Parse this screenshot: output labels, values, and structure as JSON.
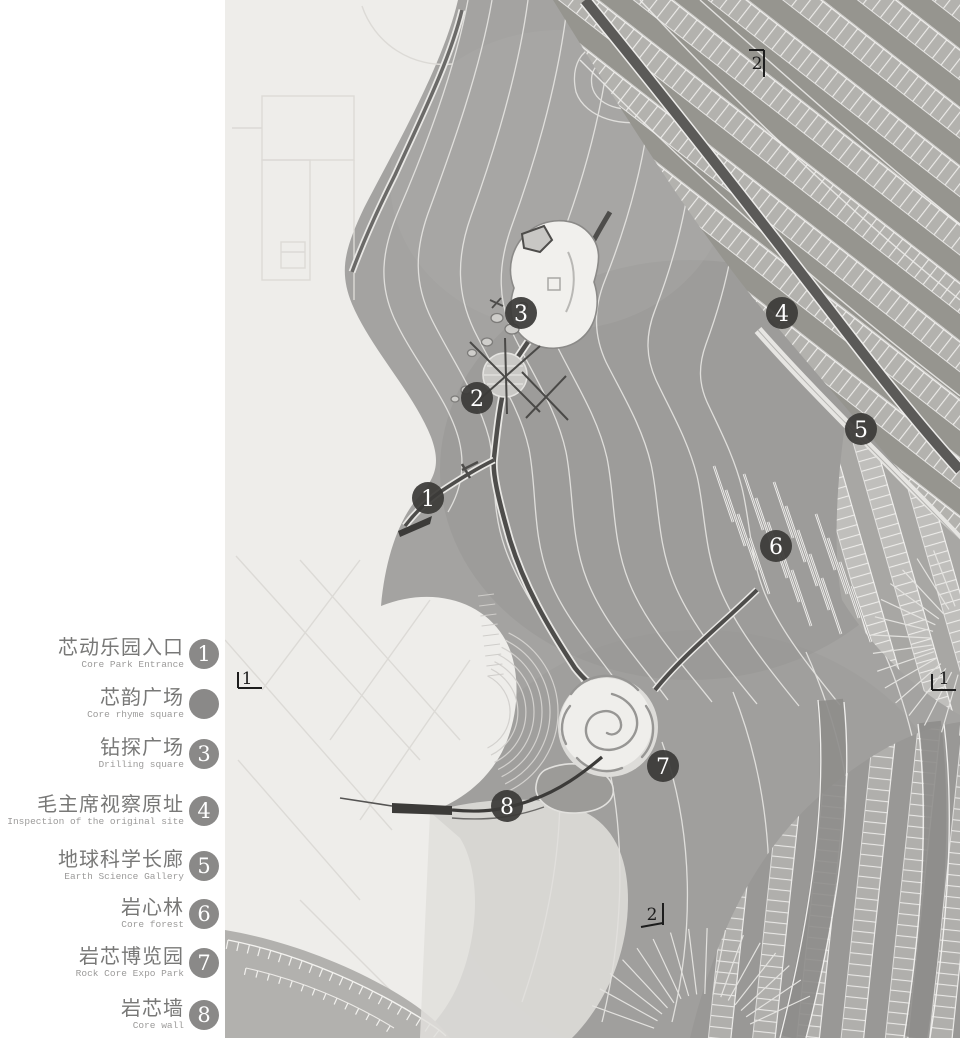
{
  "legend": {
    "items": [
      {
        "number": "1",
        "zh": "芯动乐园入口",
        "en": "Core Park Entrance",
        "y": 658
      },
      {
        "number": "",
        "zh": "芯韵广场",
        "en": "Core rhyme square",
        "y": 708
      },
      {
        "number": "3",
        "zh": "钻探广场",
        "en": "Drilling square",
        "y": 758
      },
      {
        "number": "4",
        "zh": "毛主席视察原址",
        "en": "Inspection of the original site",
        "y": 815
      },
      {
        "number": "5",
        "zh": "地球科学长廊",
        "en": "Earth Science Gallery",
        "y": 870
      },
      {
        "number": "6",
        "zh": "岩心林",
        "en": "Core forest",
        "y": 918
      },
      {
        "number": "7",
        "zh": "岩芯博览园",
        "en": "Rock Core Expo Park",
        "y": 967
      },
      {
        "number": "8",
        "zh": "岩芯墙",
        "en": "Core wall",
        "y": 1019
      }
    ],
    "colors": {
      "circle": "#8a8988",
      "number": "#ffffff",
      "zh": "#787877",
      "en": "#9c9b9a"
    }
  },
  "map": {
    "markers": [
      {
        "label": "1",
        "x": 428,
        "y": 498
      },
      {
        "label": "2",
        "x": 477,
        "y": 398
      },
      {
        "label": "3",
        "x": 521,
        "y": 313
      },
      {
        "label": "4",
        "x": 782,
        "y": 313
      },
      {
        "label": "5",
        "x": 861,
        "y": 429
      },
      {
        "label": "6",
        "x": 776,
        "y": 546
      },
      {
        "label": "7",
        "x": 663,
        "y": 766
      },
      {
        "label": "8",
        "x": 507,
        "y": 806
      }
    ],
    "section_markers": [
      {
        "label": "2",
        "x": 757,
        "y": 63,
        "orient": "top"
      },
      {
        "label": "1",
        "x": 247,
        "y": 678,
        "orient": "left"
      },
      {
        "label": "1",
        "x": 944,
        "y": 678,
        "orient": "right"
      },
      {
        "label": "2",
        "x": 652,
        "y": 914,
        "orient": "bottom"
      }
    ],
    "colors": {
      "marker_fill": "#3b3a38",
      "marker_text": "#ffffff",
      "section_text": "#1d1d1d"
    }
  }
}
